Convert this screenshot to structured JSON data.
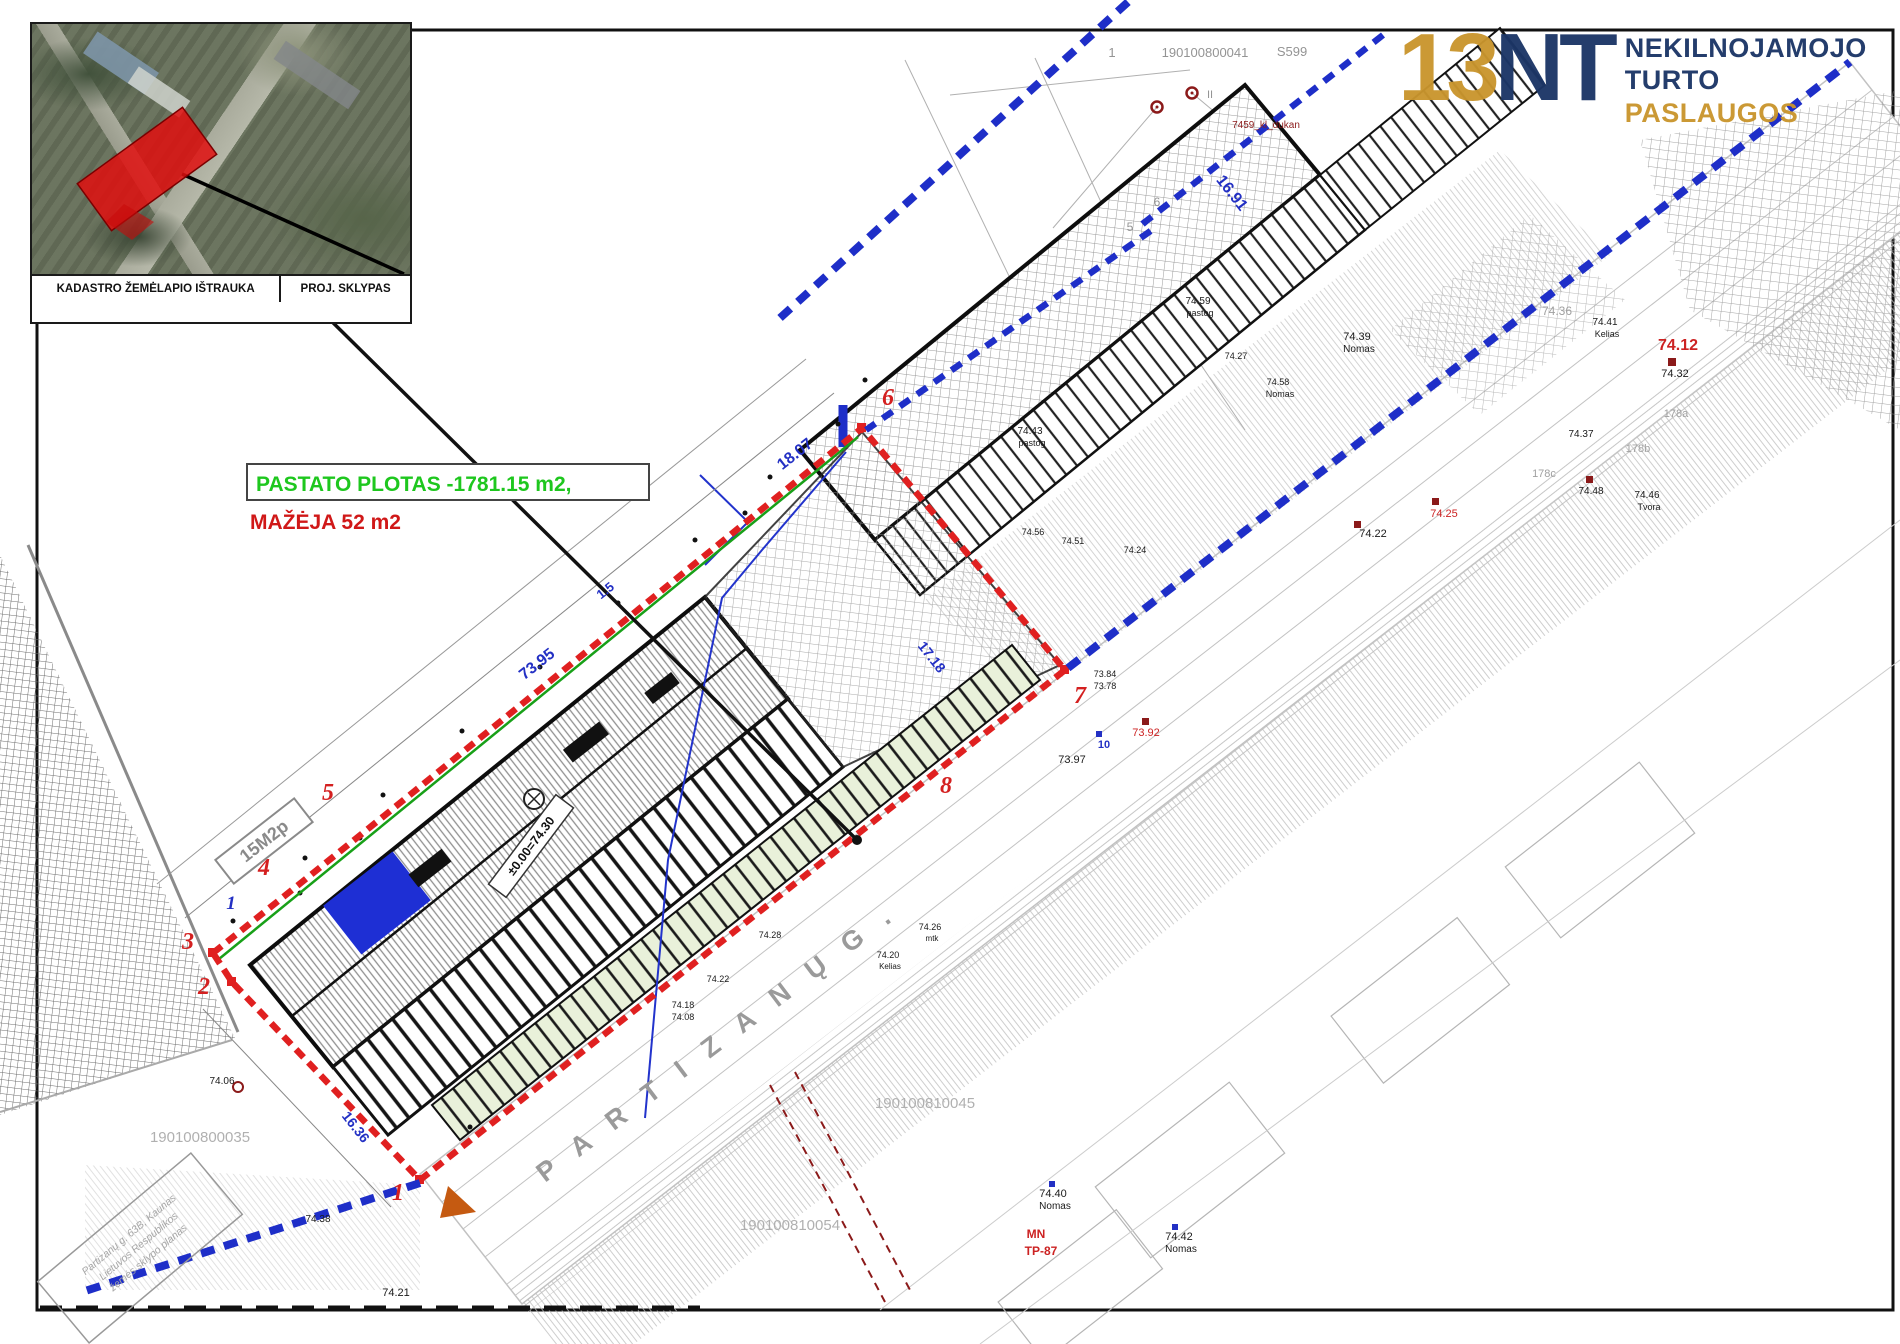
{
  "colors": {
    "boundary_red": "#e02020",
    "boundary_blue": "#1e2ec8",
    "note_green": "#1ec71e",
    "note_red": "#d01818",
    "logo_navy": "#1c3667",
    "logo_gold": "#c9952d",
    "survey_gray": "#9a9a9a"
  },
  "inset": {
    "label_left": "KADASTRO ŽEMĖLAPIO IŠTRAUKA",
    "label_right": "PROJ. SKLYPAS"
  },
  "logo": {
    "mark_gold": "13",
    "mark_navy": "NT",
    "line1": "NEKILNOJAMOJO",
    "line2": "TURTO",
    "line3": "PASLAUGOS"
  },
  "notes": {
    "area": "PASTATO PLOTAS -1781.15 m2,",
    "decrease": "MAŽĖJA 52 m2"
  },
  "street_label": "P A R T I Z A N Ų   G .",
  "level_label": "±0.00=74.30",
  "parcel_code": "15M2p",
  "stamp": {
    "line1": "Partizanų g. 63B, Kaunas",
    "line2": "Lietuvos Respublikos",
    "line3": "žemės sklypo planas"
  },
  "boundary_points": [
    {
      "t": "1",
      "x": 398,
      "y": 1200
    },
    {
      "t": "2",
      "x": 204,
      "y": 994
    },
    {
      "t": "3",
      "x": 188,
      "y": 949
    },
    {
      "t": "4",
      "x": 264,
      "y": 875
    },
    {
      "t": "5",
      "x": 328,
      "y": 800
    },
    {
      "t": "6",
      "x": 888,
      "y": 405
    },
    {
      "t": "7",
      "x": 1080,
      "y": 703
    },
    {
      "t": "8",
      "x": 946,
      "y": 793
    },
    {
      "t": "1",
      "x": 231,
      "y": 909,
      "c": "#2330c4",
      "s": 19
    }
  ],
  "dimensions": [
    {
      "t": "73.95",
      "x": 540,
      "y": 668,
      "r": -38
    },
    {
      "t": "18.07",
      "x": 798,
      "y": 458,
      "r": -38
    },
    {
      "t": "1.5",
      "x": 608,
      "y": 594,
      "r": -38,
      "s": 13
    },
    {
      "t": "17.18",
      "x": 928,
      "y": 660,
      "r": 52,
      "s": 14
    },
    {
      "t": "16.91",
      "x": 1228,
      "y": 196,
      "r": 52
    },
    {
      "t": "16.36",
      "x": 352,
      "y": 1130,
      "r": 52,
      "s": 14
    }
  ],
  "labels": [
    {
      "t": "1",
      "x": 1112,
      "y": 57,
      "c": "#949494",
      "s": 13
    },
    {
      "t": "190100800041",
      "x": 1205,
      "y": 57,
      "c": "#949494",
      "s": 13
    },
    {
      "t": "S599",
      "x": 1292,
      "y": 56,
      "c": "#949494",
      "s": 13
    },
    {
      "t": "190100800035",
      "x": 200,
      "y": 1142,
      "c": "#b0b0b0",
      "s": 15
    },
    {
      "t": "190100810045",
      "x": 925,
      "y": 1108,
      "c": "#b0b0b0",
      "s": 15
    },
    {
      "t": "190100810054",
      "x": 790,
      "y": 1230,
      "c": "#b0b0b0",
      "s": 15
    },
    {
      "t": "5",
      "x": 1130,
      "y": 231,
      "c": "#949494",
      "s": 12
    },
    {
      "t": "6",
      "x": 1157,
      "y": 206,
      "c": "#949494",
      "s": 12
    },
    {
      "t": "II",
      "x": 1210,
      "y": 98,
      "c": "#949494",
      "s": 11
    },
    {
      "t": "178a",
      "x": 1676,
      "y": 417,
      "c": "#a0a0a0",
      "s": 11
    },
    {
      "t": "178b",
      "x": 1638,
      "y": 452,
      "c": "#a0a0a0",
      "s": 11
    },
    {
      "t": "178c",
      "x": 1544,
      "y": 477,
      "c": "#a0a0a0",
      "s": 11
    },
    {
      "t": "74.36",
      "x": 1557,
      "y": 315,
      "c": "#a0a0a0",
      "s": 12
    },
    {
      "t": "74.43",
      "x": 1030,
      "y": 434
    },
    {
      "t": "pastog",
      "x": 1032,
      "y": 446,
      "s": 9
    },
    {
      "t": "74.59",
      "x": 1198,
      "y": 304
    },
    {
      "t": "pastog",
      "x": 1200,
      "y": 316,
      "s": 9
    },
    {
      "t": "74.27",
      "x": 1236,
      "y": 359,
      "s": 9
    },
    {
      "t": "74.58",
      "x": 1278,
      "y": 385,
      "s": 9
    },
    {
      "t": "Nomas",
      "x": 1280,
      "y": 397,
      "s": 9
    },
    {
      "t": "74.39",
      "x": 1357,
      "y": 340,
      "s": 11
    },
    {
      "t": "Nomas",
      "x": 1359,
      "y": 352,
      "s": 10
    },
    {
      "t": "74.56",
      "x": 1033,
      "y": 535,
      "s": 9
    },
    {
      "t": "74.51",
      "x": 1073,
      "y": 544,
      "s": 9
    },
    {
      "t": "74.24",
      "x": 1135,
      "y": 553,
      "s": 9
    },
    {
      "t": "73.84",
      "x": 1105,
      "y": 677,
      "s": 9
    },
    {
      "t": "73.78",
      "x": 1105,
      "y": 689,
      "s": 9
    },
    {
      "t": "73.97",
      "x": 1072,
      "y": 763,
      "s": 11
    },
    {
      "t": "73.92",
      "x": 1146,
      "y": 736,
      "c": "#cc2222",
      "s": 11
    },
    {
      "t": "10",
      "x": 1104,
      "y": 748,
      "c": "#2330c4",
      "s": 11,
      "b": 1
    },
    {
      "t": "74.22",
      "x": 1373,
      "y": 537,
      "s": 11
    },
    {
      "t": "74.25",
      "x": 1444,
      "y": 517,
      "c": "#cc2222",
      "s": 11
    },
    {
      "t": "74.12",
      "x": 1678,
      "y": 350,
      "c": "#cc2222",
      "s": 16,
      "b": 1
    },
    {
      "t": "74.32",
      "x": 1675,
      "y": 377,
      "s": 11
    },
    {
      "t": "74.37",
      "x": 1581,
      "y": 437
    },
    {
      "t": "74.48",
      "x": 1591,
      "y": 494
    },
    {
      "t": "74.46",
      "x": 1647,
      "y": 498
    },
    {
      "t": "Tvora",
      "x": 1649,
      "y": 510,
      "s": 9
    },
    {
      "t": "74.41",
      "x": 1605,
      "y": 325
    },
    {
      "t": "Kelias",
      "x": 1607,
      "y": 337,
      "s": 9
    },
    {
      "t": "7459_kl_dukan",
      "x": 1266,
      "y": 128,
      "c": "#8b1a1a",
      "s": 10
    },
    {
      "t": "74.06",
      "x": 222,
      "y": 1084
    },
    {
      "t": "74.21",
      "x": 396,
      "y": 1296,
      "s": 11
    },
    {
      "t": "74.38",
      "x": 318,
      "y": 1222
    },
    {
      "t": "74.28",
      "x": 770,
      "y": 938,
      "s": 9
    },
    {
      "t": "74.22",
      "x": 718,
      "y": 982,
      "s": 9
    },
    {
      "t": "74.18",
      "x": 683,
      "y": 1008,
      "s": 9
    },
    {
      "t": "74.08",
      "x": 683,
      "y": 1020,
      "s": 9
    },
    {
      "t": "74.20",
      "x": 888,
      "y": 958,
      "s": 9
    },
    {
      "t": "Kelias",
      "x": 890,
      "y": 969,
      "s": 8
    },
    {
      "t": "74.26",
      "x": 930,
      "y": 930,
      "s": 9
    },
    {
      "t": "mtk",
      "x": 932,
      "y": 941,
      "s": 8
    },
    {
      "t": "74.40",
      "x": 1053,
      "y": 1197,
      "s": 11
    },
    {
      "t": "Nomas",
      "x": 1055,
      "y": 1209,
      "s": 10
    },
    {
      "t": "74.42",
      "x": 1179,
      "y": 1240,
      "s": 11
    },
    {
      "t": "Nomas",
      "x": 1181,
      "y": 1252,
      "s": 10
    },
    {
      "t": "MN",
      "x": 1036,
      "y": 1238,
      "c": "#cc2222",
      "s": 12,
      "b": 1
    },
    {
      "t": "TP-87",
      "x": 1041,
      "y": 1255,
      "c": "#cc2222",
      "s": 12,
      "b": 1
    }
  ]
}
